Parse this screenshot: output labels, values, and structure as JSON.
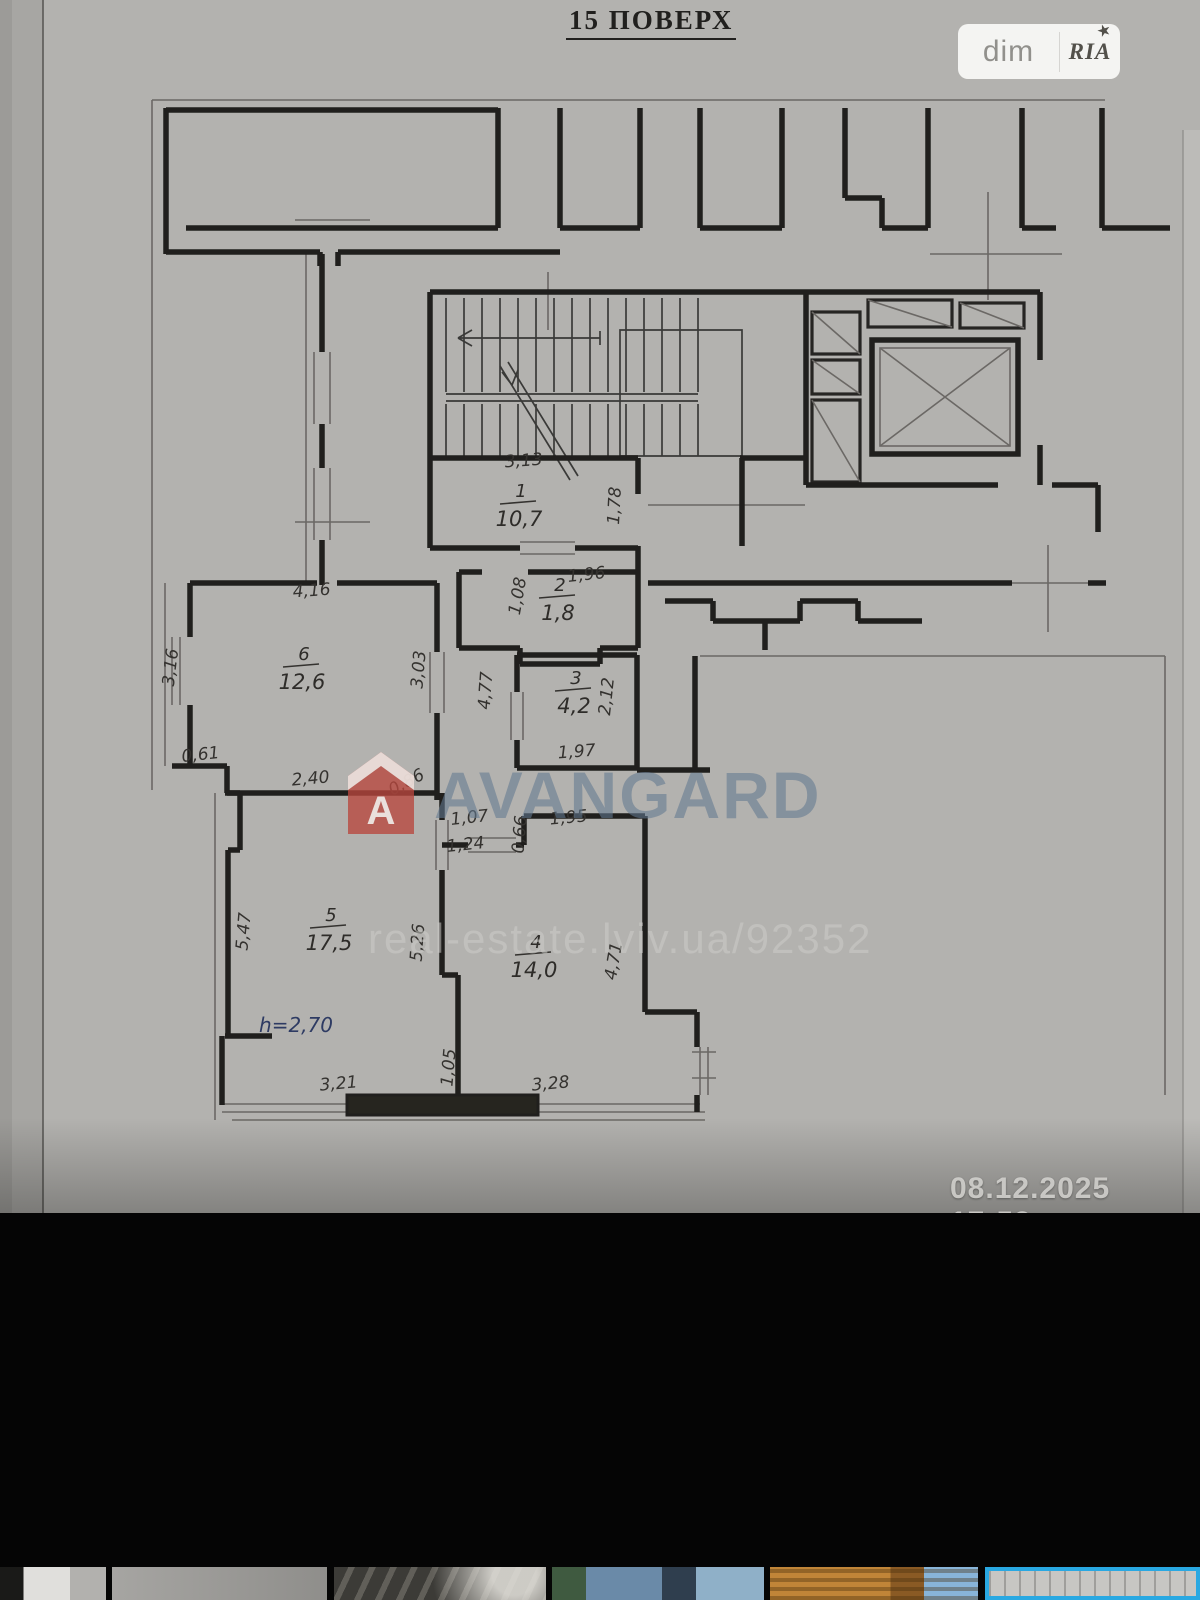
{
  "photo": {
    "floor_title": "15 ПОВЕРХ",
    "timestamp": "08.12.2025 17:53",
    "badge": {
      "left": "dim",
      "right": "RIA",
      "star": "★"
    },
    "watermark": {
      "brand": "AVANGARD",
      "logo_letter": "A",
      "url": "real-estate.lviv.ua/92352"
    },
    "plan": {
      "height_note": "h=2,70",
      "rooms": [
        {
          "number": "1",
          "area": "10,7",
          "x": 521,
          "y": 497
        },
        {
          "number": "2",
          "area": "1,8",
          "x": 560,
          "y": 591
        },
        {
          "number": "3",
          "area": "4,2",
          "x": 576,
          "y": 684
        },
        {
          "number": "4",
          "area": "14,0",
          "x": 536,
          "y": 948
        },
        {
          "number": "5",
          "area": "17,5",
          "x": 331,
          "y": 921
        },
        {
          "number": "6",
          "area": "12,6",
          "x": 304,
          "y": 660
        }
      ],
      "dimensions": [
        {
          "v": "3,13",
          "x": 524,
          "y": 466,
          "r": -4
        },
        {
          "v": "1,78",
          "x": 620,
          "y": 506,
          "r": -87
        },
        {
          "v": "1,96",
          "x": 587,
          "y": 580,
          "r": -6
        },
        {
          "v": "1,08",
          "x": 523,
          "y": 597,
          "r": -80
        },
        {
          "v": "4,16",
          "x": 312,
          "y": 596,
          "r": -4
        },
        {
          "v": "3,16",
          "x": 176,
          "y": 668,
          "r": -83
        },
        {
          "v": "3,03",
          "x": 424,
          "y": 670,
          "r": -85
        },
        {
          "v": "0,61",
          "x": 201,
          "y": 760,
          "r": -6
        },
        {
          "v": "2,40",
          "x": 311,
          "y": 784,
          "r": -5
        },
        {
          "v": "0,86",
          "x": 409,
          "y": 787,
          "r": -28
        },
        {
          "v": "4,77",
          "x": 491,
          "y": 691,
          "r": -86
        },
        {
          "v": "2,12",
          "x": 612,
          "y": 697,
          "r": -84
        },
        {
          "v": "1,97",
          "x": 577,
          "y": 757,
          "r": -4
        },
        {
          "v": "1,07",
          "x": 470,
          "y": 823,
          "r": -6
        },
        {
          "v": "1,24",
          "x": 466,
          "y": 850,
          "r": -6
        },
        {
          "v": "0,66",
          "x": 525,
          "y": 835,
          "r": -85
        },
        {
          "v": "1,95",
          "x": 569,
          "y": 823,
          "r": -5
        },
        {
          "v": "5,47",
          "x": 249,
          "y": 932,
          "r": -85
        },
        {
          "v": "5,26",
          "x": 423,
          "y": 943,
          "r": -86
        },
        {
          "v": "4,71",
          "x": 619,
          "y": 962,
          "r": -80
        },
        {
          "v": "1,05",
          "x": 454,
          "y": 1068,
          "r": -85
        },
        {
          "v": "3,21",
          "x": 339,
          "y": 1089,
          "r": -5
        },
        {
          "v": "3,28",
          "x": 551,
          "y": 1089,
          "r": -5
        }
      ]
    }
  },
  "colors": {
    "accent_blue": "#29a8e2",
    "watermark_red": "#b9463e",
    "watermark_blue_gray": "#62788f"
  },
  "gallery": {
    "thumbnails": [
      {
        "label": "thumb-1",
        "selected": false
      },
      {
        "label": "thumb-2",
        "selected": false
      },
      {
        "label": "thumb-3",
        "selected": false
      },
      {
        "label": "thumb-4",
        "selected": false
      },
      {
        "label": "thumb-5",
        "selected": false
      },
      {
        "label": "thumb-6-floor-plan",
        "selected": true
      }
    ]
  }
}
